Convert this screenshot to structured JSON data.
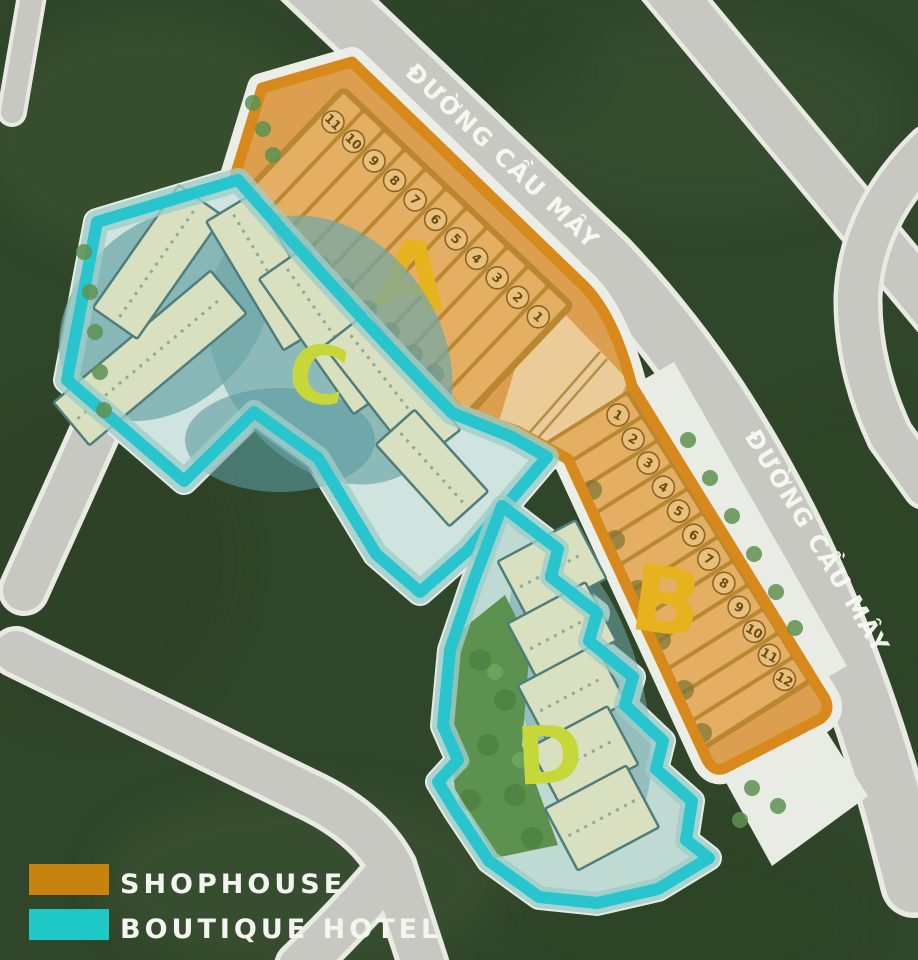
{
  "title": "Resort masterplan site map",
  "streets": {
    "top_label": "ĐƯỜNG CẦU MÂY",
    "right_label": "ĐƯỜNG CẦU MÂY"
  },
  "zones": {
    "a": {
      "label": "A",
      "type": "SHOPHOUSE",
      "lots": [
        "11",
        "10",
        "9",
        "8",
        "7",
        "6",
        "5",
        "4",
        "3",
        "2",
        "1"
      ]
    },
    "b": {
      "label": "B",
      "type": "SHOPHOUSE",
      "lots": [
        "1",
        "2",
        "3",
        "4",
        "5",
        "6",
        "7",
        "8",
        "9",
        "10",
        "11",
        "12"
      ]
    },
    "c": {
      "label": "C",
      "type": "BOUTIQUE HOTEL"
    },
    "d": {
      "label": "D",
      "type": "BOUTIQUE HOTEL"
    }
  },
  "legend": {
    "items": [
      {
        "label": "SHOPHOUSE",
        "color": "#C8830F"
      },
      {
        "label": "BOUTIQUE HOTEL",
        "color": "#1EC8C6"
      }
    ]
  },
  "colors": {
    "label_gold": "#E6B31E",
    "label_green": "#C6D839",
    "shophouse_fill": "#E4AF63",
    "shophouse_border": "#D8891B",
    "hotel_outline": "#28C5CF"
  }
}
